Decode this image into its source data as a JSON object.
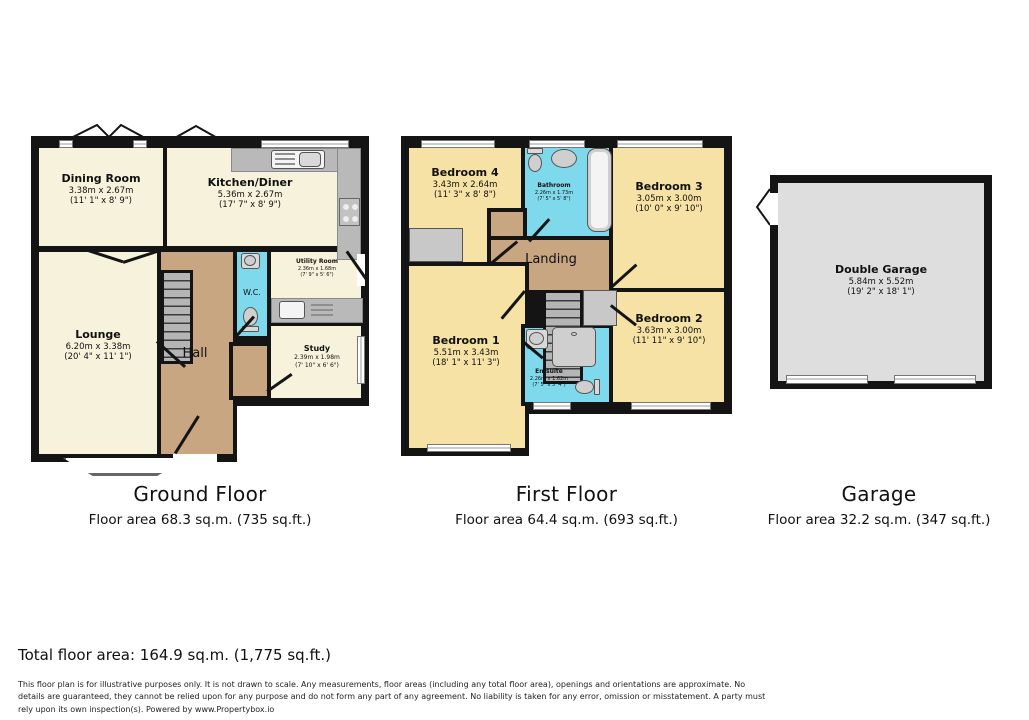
{
  "colors": {
    "wall": "#141414",
    "cream": "#f7f2dc",
    "bedroom_yellow": "#f5e2a4",
    "corridor_tan": "#c8a681",
    "wet_room_cyan": "#7fd9ed",
    "garage_gray": "#dedede",
    "counter_gray": "#b9b9b9",
    "stair_gray": "#b5b5b5",
    "window_white": "#ffffff"
  },
  "floors": [
    {
      "id": "ground-floor",
      "title": "Ground Floor",
      "area_label": "Floor area 68.3 sq.m. (735 sq.ft.)",
      "rooms": [
        {
          "name": "Dining Room",
          "dim_m": "3.38m x 2.67m",
          "dim_ft": "(11' 1\" x 8' 9\")"
        },
        {
          "name": "Kitchen/Diner",
          "dim_m": "5.36m x 2.67m",
          "dim_ft": "(17' 7\" x 8' 9\")"
        },
        {
          "name": "Lounge",
          "dim_m": "6.20m x 3.38m",
          "dim_ft": "(20' 4\" x 11' 1\")"
        },
        {
          "name": "Hall"
        },
        {
          "name": "W.C."
        },
        {
          "name": "Utility Room",
          "dim_m": "2.36m x 1.68m",
          "dim_ft": "(7' 9\" x 5' 6\")"
        },
        {
          "name": "Study",
          "dim_m": "2.39m x 1.98m",
          "dim_ft": "(7' 10\" x 6' 6\")"
        }
      ]
    },
    {
      "id": "first-floor",
      "title": "First Floor",
      "area_label": "Floor area 64.4 sq.m. (693 sq.ft.)",
      "rooms": [
        {
          "name": "Bedroom 4",
          "dim_m": "3.43m x 2.64m",
          "dim_ft": "(11' 3\" x 8' 8\")"
        },
        {
          "name": "Bathroom",
          "dim_m": "2.26m x 1.73m",
          "dim_ft": "(7' 5\" x 5' 8\")"
        },
        {
          "name": "Bedroom 3",
          "dim_m": "3.05m x 3.00m",
          "dim_ft": "(10' 0\" x 9' 10\")"
        },
        {
          "name": "Landing"
        },
        {
          "name": "Bedroom 1",
          "dim_m": "5.51m x 3.43m",
          "dim_ft": "(18' 1\" x 11' 3\")"
        },
        {
          "name": "En-suite",
          "dim_m": "2.26m x 1.62m",
          "dim_ft": "(7' 5\" x 5' 4\")"
        },
        {
          "name": "Bedroom 2",
          "dim_m": "3.63m x 3.00m",
          "dim_ft": "(11' 11\" x 9' 10\")"
        }
      ]
    },
    {
      "id": "garage",
      "title": "Garage",
      "area_label": "Floor area 32.2 sq.m. (347 sq.ft.)",
      "rooms": [
        {
          "name": "Double Garage",
          "dim_m": "5.84m x 5.52m",
          "dim_ft": "(19' 2\" x 18' 1\")"
        }
      ]
    }
  ],
  "footer": {
    "total": "Total floor area: 164.9 sq.m. (1,775 sq.ft.)",
    "disclaimer": "This floor plan is for illustrative purposes only. It is not drawn to scale. Any measurements, floor areas (including any total floor area), openings and orientations are approximate. No details are guaranteed, they cannot be relied upon for any purpose and do not form any part of any agreement. No liability is taken for any error, omission or misstatement. A party must rely upon its own inspection(s). Powered by www.Propertybox.io"
  }
}
